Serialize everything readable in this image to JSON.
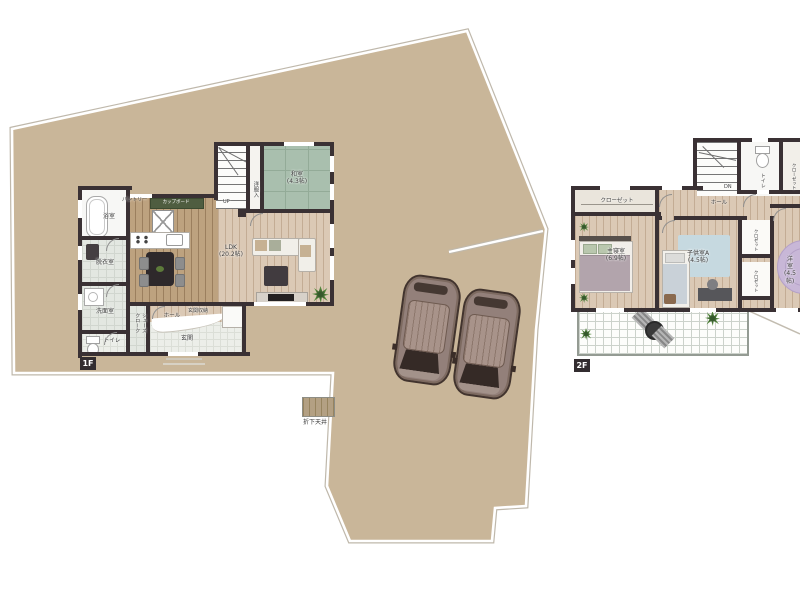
{
  "legend": {
    "dropped_ceiling": "折下天井"
  },
  "f1": {
    "tag": "1F",
    "bath": "浴室",
    "dressing": "脱衣室",
    "washroom": "洗面室",
    "toilet": "トイレ",
    "shoes_closet": "シューズクローク",
    "hall": "ホール",
    "entrance": "玄関",
    "entrance_storage": "玄関収納",
    "pantry": "パントリー",
    "cupboard": "カップボード",
    "ldk": "LDK\n(20.2帖)",
    "japanese_room": "和室\n(4.3帖)",
    "clothes_closet": "洋服入",
    "stairs_up": "UP"
  },
  "f2": {
    "tag": "2F",
    "closet": "クローゼット",
    "master_bedroom": "主寝室\n(6.9帖)",
    "kids_room_a": "子供室A\n(4.5帖)",
    "western_room": "洋室\n(4.5帖)",
    "closet_a": "クロゼット",
    "closet_b": "クロゼット",
    "closet_c": "クローゼット",
    "hall": "ホール",
    "toilet": "トイレ",
    "stairs_dn": "DN"
  },
  "colors": {
    "lot": "#c9b699",
    "wall": "#3a3134",
    "wood_light": "#dbc9b5",
    "wood_dark": "#bda27f",
    "tatami": "#a9bfae",
    "cupboard_green": "#4f5d40"
  }
}
